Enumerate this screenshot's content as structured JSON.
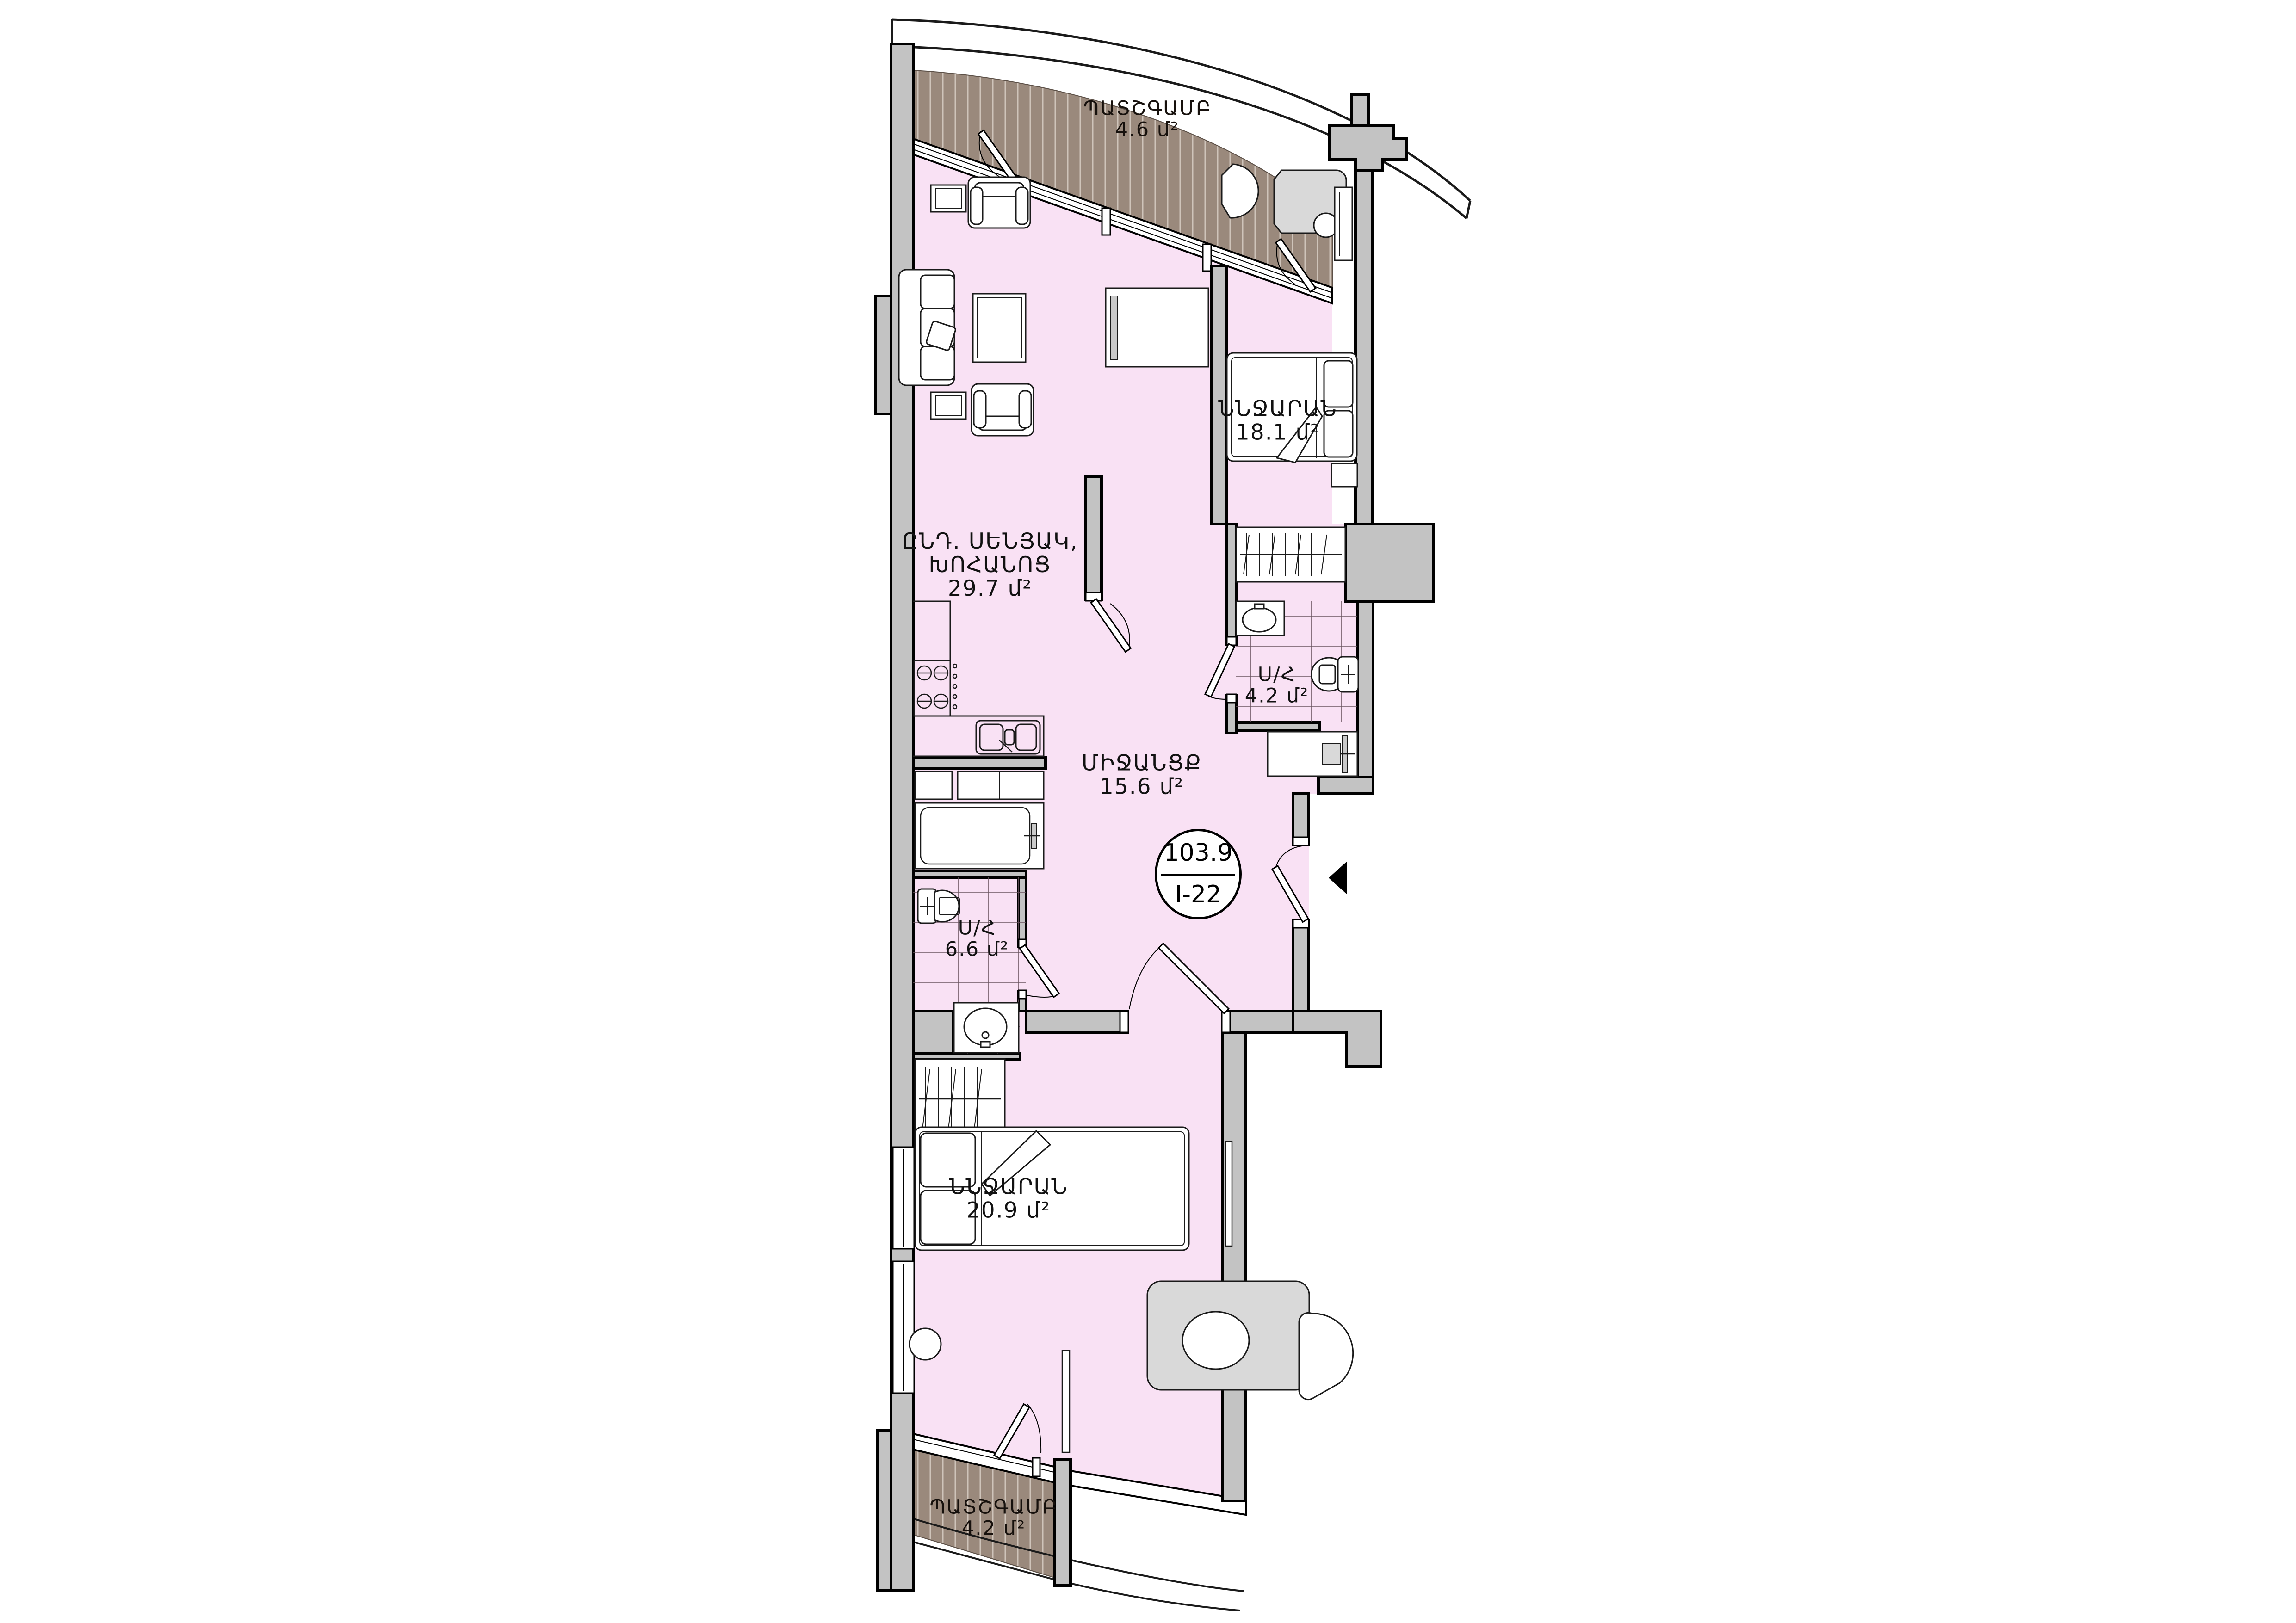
{
  "plan": {
    "title": "apartment-floor-plan",
    "badge": {
      "total_area": "103.9",
      "unit_id": "I-22"
    },
    "rooms": {
      "balcony_top": {
        "name": "ՊԱՏՇԳԱՄԲ",
        "area": "4.6 մ²"
      },
      "bedroom_top": {
        "name": "ՆՆՋԱՐԱՆ",
        "area": "18.1 մ²"
      },
      "living_kitchen": {
        "name1": "ԸՆԴ. ՍԵՆՅԱԿ,",
        "name2": "ԽՈՀԱՆՈՑ",
        "area": "29.7 մ²"
      },
      "bathroom_top": {
        "name": "Ս/Հ",
        "area": "4.2 մ²"
      },
      "hallway": {
        "name": "ՄԻՋԱՆՑՔ",
        "area": "15.6 մ²"
      },
      "bathroom_bottom": {
        "name": "Ս/Հ",
        "area": "6.6 մ²"
      },
      "bedroom_bottom": {
        "name": "ՆՆՋԱՐԱՆ",
        "area": "20.9 մ²"
      },
      "balcony_bottom": {
        "name": "ՊԱՏՇԳԱՄԲ",
        "area": "4.2 մ²"
      }
    },
    "colors": {
      "floor_pink": "#f9e1f4",
      "balcony_brown": "#9a897c",
      "wall_gray": "#c3c3c3",
      "outline": "#000000",
      "furniture_gray": "#d9d9d9"
    }
  }
}
